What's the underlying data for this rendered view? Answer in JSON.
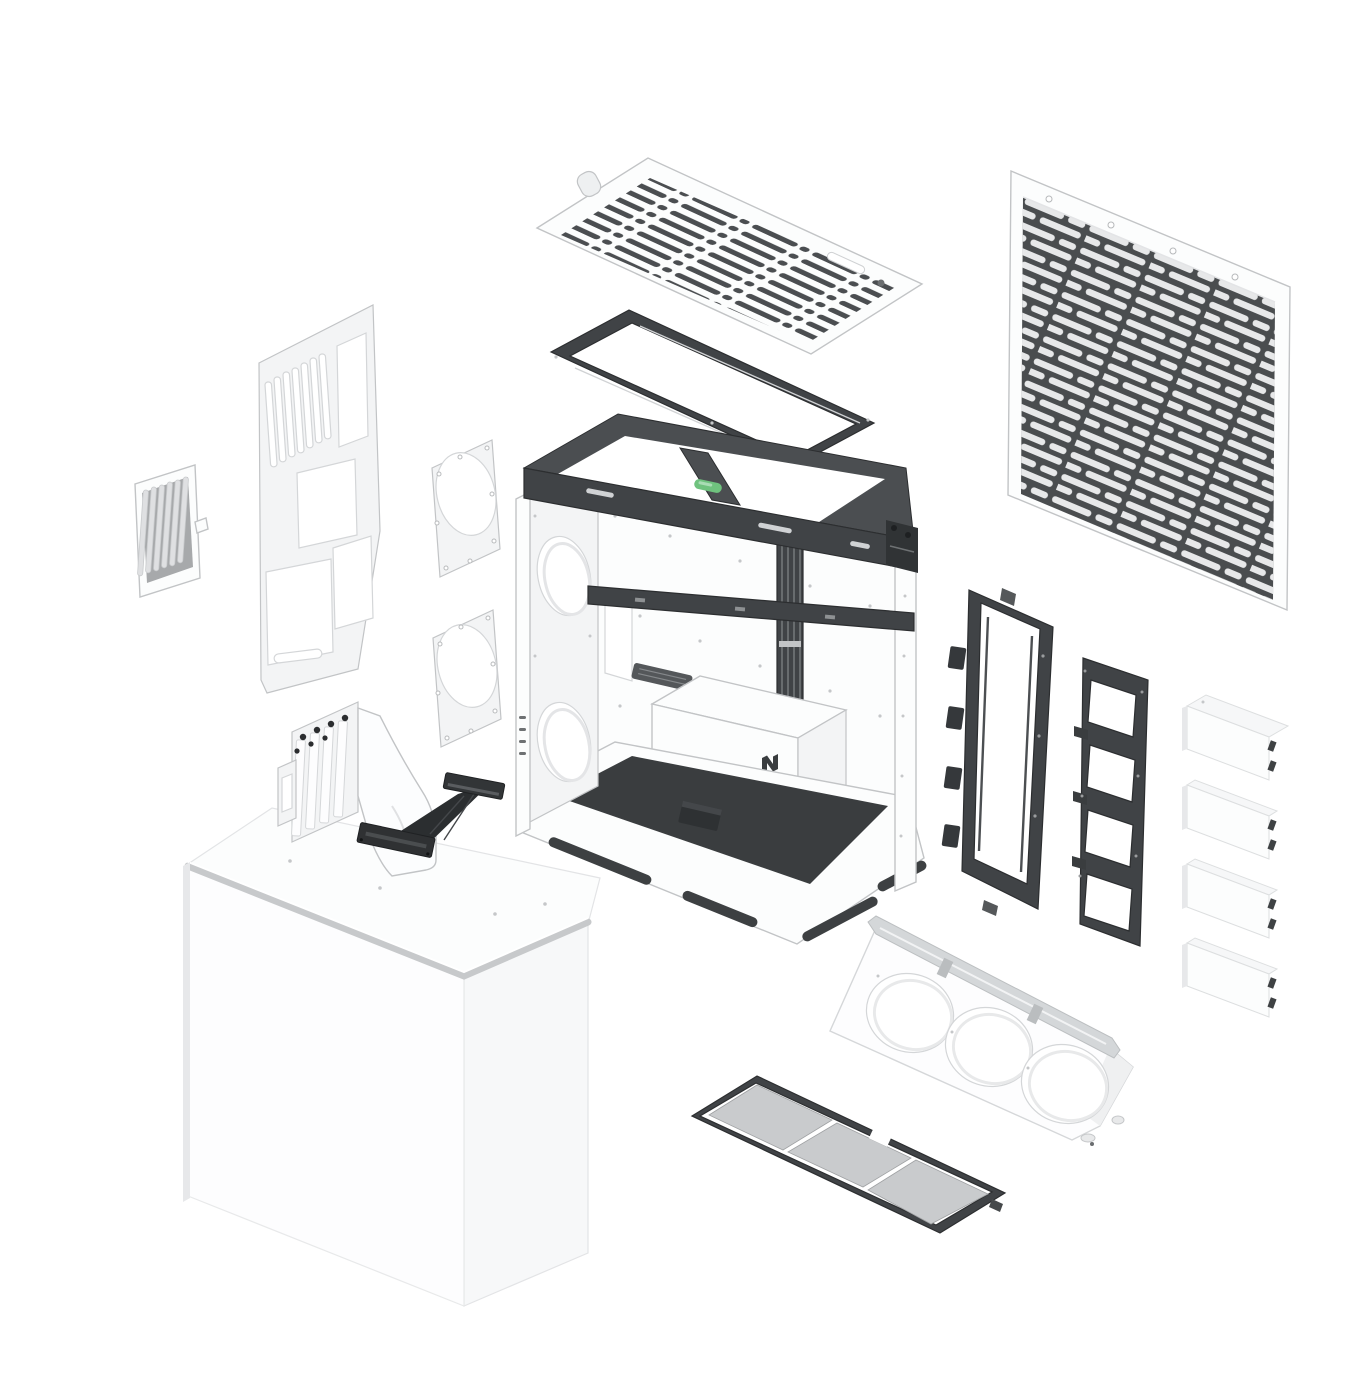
{
  "image": {
    "title": "Exploded view diagram of a white dual-chamber mid-tower PC case showing all removable panels, brackets, filters and accessories",
    "type": "exploded-view product diagram",
    "background": "#ffffff",
    "logo_letter": "N"
  },
  "palette": {
    "white": "#ffffff",
    "panel_white": "#fcfdfd",
    "panel_shade": "#f3f4f5",
    "panel_shade_dark": "#e7e8ea",
    "edge_gray": "#c7c9cb",
    "outline": "#c2c4c6",
    "hole_stroke": "#d4d6d8",
    "dark": "#404346",
    "dark_mid": "#4b4e51",
    "dark_stroke": "#2c2e30",
    "detail_light": "#d0d2d4",
    "mesh_bg": "#4a4d4f",
    "mesh_slot_light": "#e7e8e9",
    "filter_mesh": "#c9cbcd",
    "filter_mesh_line": "#9fa1a3",
    "accent_green": "#6fc27e",
    "accent_green_light": "#a9dcb4",
    "riser_black": "#2c2f31",
    "screw_dark": "#2b2d2f",
    "dot_gray": "#c5c7c9",
    "shroud_vent": "#54575a"
  },
  "parts": [
    {
      "id": "top-exhaust-panel",
      "label": "Top exhaust vent panel with pull tab"
    },
    {
      "id": "top-radiator-bracket",
      "label": "Top radiator mounting bracket"
    },
    {
      "id": "side-mesh-panel",
      "label": "Side mesh panel"
    },
    {
      "id": "main-chassis",
      "label": "Main chassis frame with PSU shroud"
    },
    {
      "id": "rear-panel",
      "label": "Rear panel with expansion slot vents"
    },
    {
      "id": "rear-vent-cover",
      "label": "Rear vent cover"
    },
    {
      "id": "fan-adapter-top",
      "label": "Fan adapter plate (upper)"
    },
    {
      "id": "fan-adapter-bottom",
      "label": "Fan adapter plate (lower)"
    },
    {
      "id": "vertical-gpu-bracket",
      "label": "Vertical GPU mounting bracket"
    },
    {
      "id": "pcie-riser-cable",
      "label": "PCIe riser cable"
    },
    {
      "id": "wraparound-panel",
      "label": "Wrap-around front and side panel"
    },
    {
      "id": "fan-radiator-tray",
      "label": "Fan and radiator tray"
    },
    {
      "id": "drive-mount-ladder",
      "label": "Drive mounting ladder bracket"
    },
    {
      "id": "drive-bay-covers",
      "label": "Stacked drive bay covers"
    },
    {
      "id": "bottom-fan-bracket",
      "label": "Triple fan mounting bracket with light diffuser"
    },
    {
      "id": "bottom-dust-filter",
      "label": "Bottom dust filter"
    },
    {
      "id": "brand-logo",
      "label": "Brand N logo on PSU shroud"
    },
    {
      "id": "accent-latch",
      "label": "Green release latch"
    }
  ]
}
